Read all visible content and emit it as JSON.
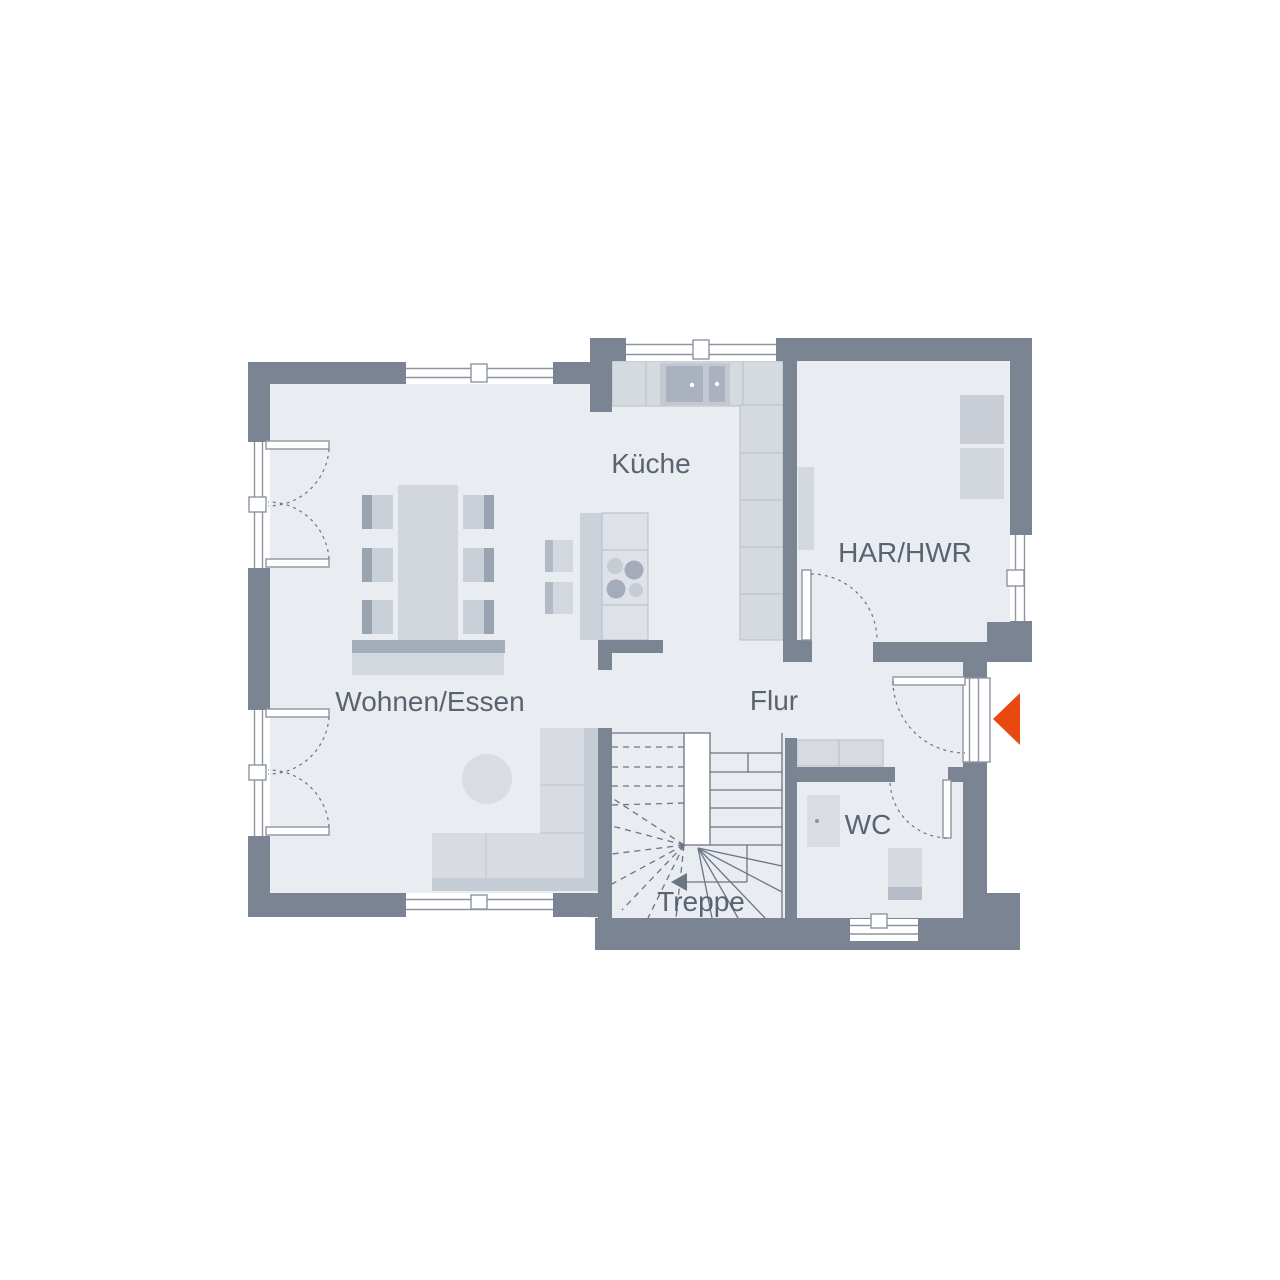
{
  "plan": {
    "type": "floor-plan",
    "rooms": [
      {
        "id": "kueche",
        "label": "Küche"
      },
      {
        "id": "har-hwr",
        "label": "HAR/HWR"
      },
      {
        "id": "wohnen-essen",
        "label": "Wohnen/Essen"
      },
      {
        "id": "flur",
        "label": "Flur"
      },
      {
        "id": "wc",
        "label": "WC"
      },
      {
        "id": "treppe",
        "label": "Treppe"
      }
    ],
    "colors": {
      "wall": "#7a8492",
      "floor": "#e9ecf1",
      "furniture_light": "#d8dbe2",
      "furniture_mid": "#c6ccd5",
      "furniture_dark": "#9aa3b0",
      "counter": "#d5d9e0",
      "sink_dark": "#a9b2be",
      "outline": "#8d95a1",
      "stair_line": "#6c7584",
      "label_text": "#5a6370",
      "entrance_accent": "#e8490f"
    },
    "icons": [
      {
        "name": "entrance-arrow-icon"
      },
      {
        "name": "stairs-direction-arrow-icon"
      }
    ]
  }
}
